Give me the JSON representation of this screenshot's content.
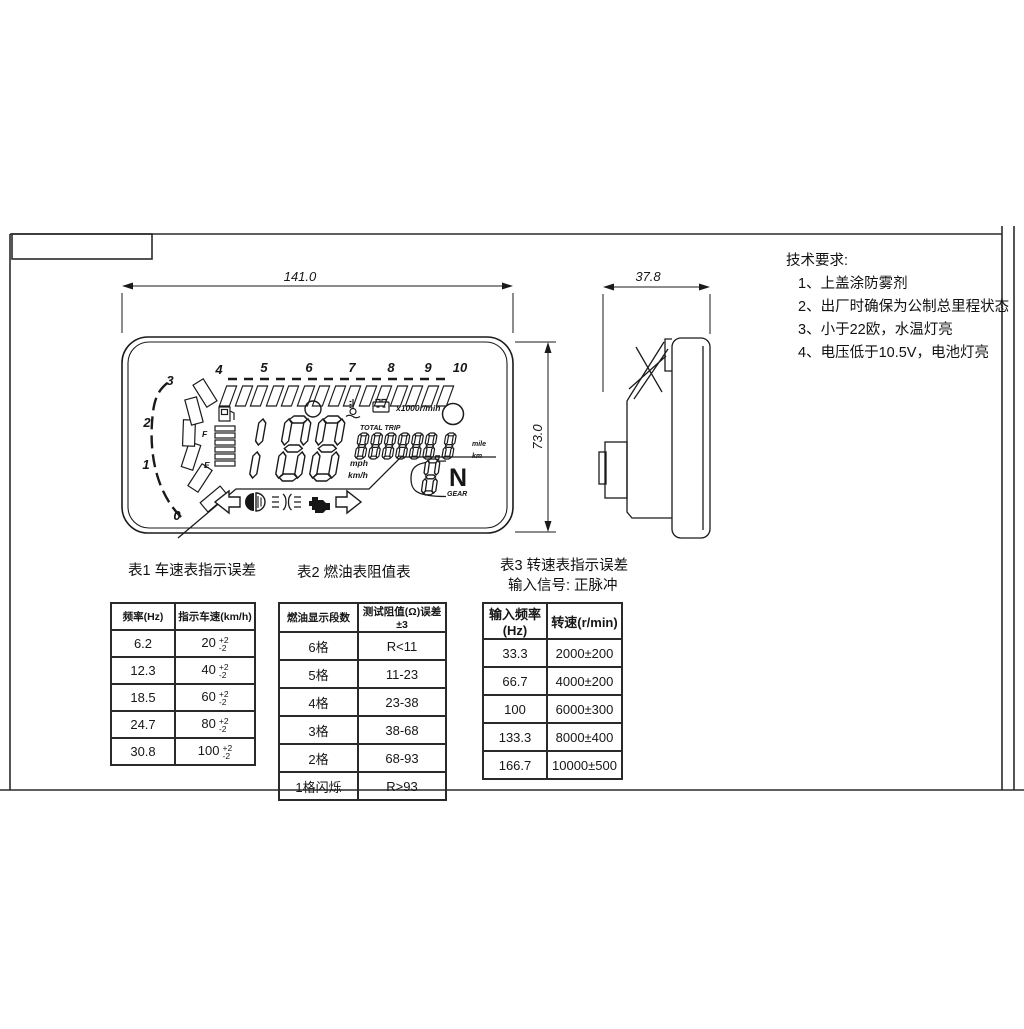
{
  "doc": {
    "dims": {
      "front_width": "141.0",
      "side_depth": "37.8",
      "front_height": "73.0"
    },
    "lcd": {
      "tach": [
        "0",
        "1",
        "2",
        "3",
        "4",
        "5",
        "6",
        "7",
        "8",
        "9",
        "10"
      ],
      "x1000": "x1000r/min",
      "total_trip": "TOTAL  TRIP",
      "mile": "mile",
      "km": "km",
      "mph": "mph",
      "kmh": "km/h",
      "fuel_f": "F",
      "fuel_e": "E",
      "gear_n": "N",
      "gear_label": "GEAR"
    }
  },
  "tech": {
    "title": "技术要求:",
    "items": [
      "1、上盖涂防雾剂",
      "2、出厂时确保为公制总里程状态",
      "3、小于22欧，水温灯亮",
      "4、电压低于10.5V，电池灯亮"
    ]
  },
  "tables": {
    "t1": {
      "title": "表1 车速表指示误差",
      "headers": [
        "频率(Hz)",
        "指示车速(km/h)"
      ],
      "rows": [
        {
          "hz": "6.2",
          "v": "20",
          "up": "+2",
          "dn": "-2"
        },
        {
          "hz": "12.3",
          "v": "40",
          "up": "+2",
          "dn": "-2"
        },
        {
          "hz": "18.5",
          "v": "60",
          "up": "+2",
          "dn": "-2"
        },
        {
          "hz": "24.7",
          "v": "80",
          "up": "+2",
          "dn": "-2"
        },
        {
          "hz": "30.8",
          "v": "100",
          "up": "+2",
          "dn": "-2"
        }
      ]
    },
    "t2": {
      "title": "表2 燃油表阻值表",
      "headers": [
        "燃油显示段数",
        "测试阻值(Ω)误差±3"
      ],
      "rows": [
        [
          "6格",
          "R<11"
        ],
        [
          "5格",
          "11-23"
        ],
        [
          "4格",
          "23-38"
        ],
        [
          "3格",
          "38-68"
        ],
        [
          "2格",
          "68-93"
        ],
        [
          "1格闪烁",
          "R>93"
        ]
      ]
    },
    "t3": {
      "title": "表3 转速表指示误差",
      "subtitle": "输入信号: 正脉冲",
      "headers": [
        "输入频率(Hz)",
        "转速(r/min)"
      ],
      "rows": [
        [
          "33.3",
          "2000±200"
        ],
        [
          "66.7",
          "4000±200"
        ],
        [
          "100",
          "6000±300"
        ],
        [
          "133.3",
          "8000±400"
        ],
        [
          "166.7",
          "10000±500"
        ]
      ]
    }
  }
}
